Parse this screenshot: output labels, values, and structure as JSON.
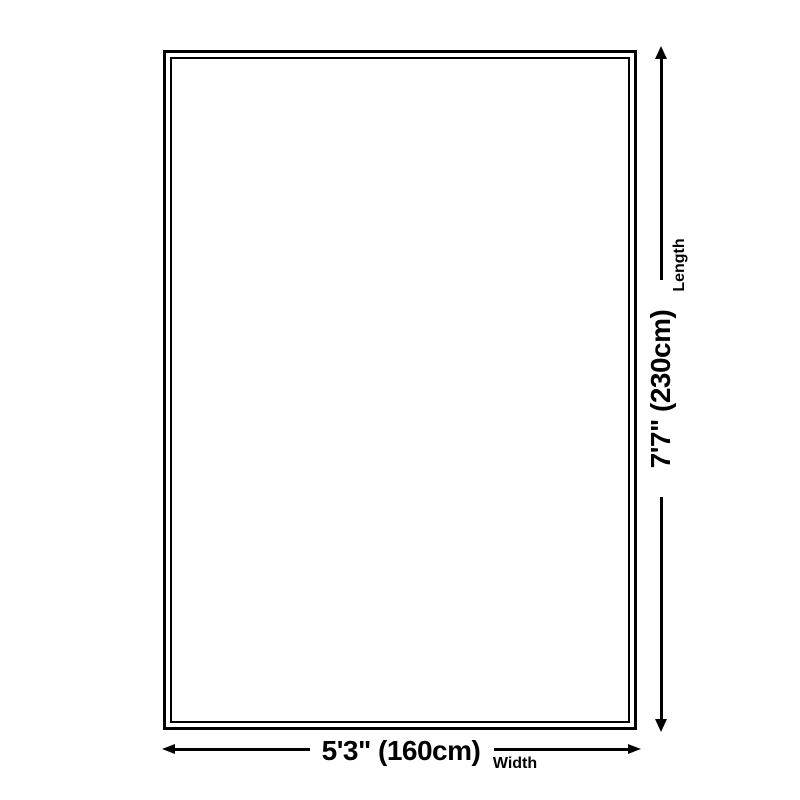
{
  "diagram": {
    "type": "product-dimension-diagram",
    "width_dimension": {
      "value": "5'3\" (160cm)",
      "label": "Width"
    },
    "length_dimension": {
      "value": "7'7\" (230cm)",
      "label": "Length"
    },
    "colors": {
      "line": "#000000",
      "background": "#ffffff"
    }
  }
}
